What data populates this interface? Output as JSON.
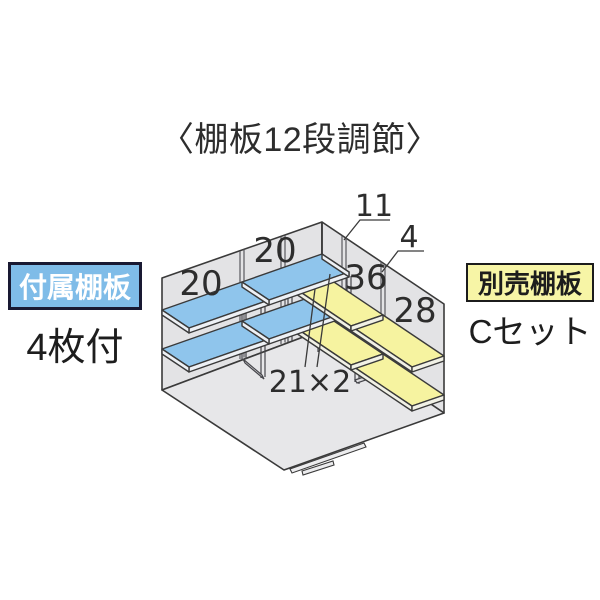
{
  "title": "〈棚板12段調節〉",
  "attached_shelf": {
    "tag": "付属棚板",
    "note": "4枚付",
    "tag_color": "#7fbce8",
    "board_color": "#8fc5ec"
  },
  "optional_shelf": {
    "tag": "別売棚板",
    "note": "Cセット",
    "tag_color": "#f7f5a6",
    "board_color": "#f6f3a0"
  },
  "diagram": {
    "description": "isometric view of shed interior corner with two levels of shelf boards on each wall",
    "labels": {
      "left_bay_1": "20",
      "left_bay_2": "20",
      "right_bay_1": "36",
      "right_bay_2": "28",
      "corner_pillar": "11",
      "divider_pillar": "4",
      "supports": "21×2"
    },
    "colors": {
      "wall": "#e3e3e5",
      "floor": "#e7e7e9",
      "outline": "#3a3a3a"
    }
  }
}
